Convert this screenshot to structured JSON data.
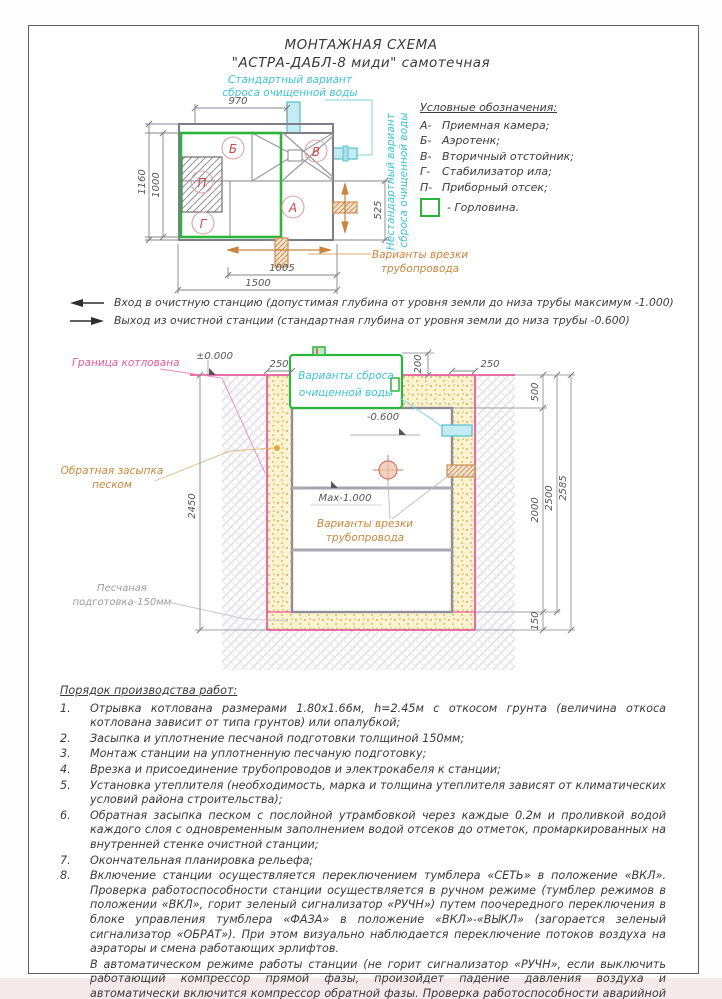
{
  "page": {
    "title_line1": "МОНТАЖНАЯ СХЕМА",
    "title_line2": "\"АСТРА-ДАБЛ-8 миди\"  самотечная"
  },
  "colors": {
    "green": "#2cb53c",
    "cyan": "#3fc3d2",
    "magenta": "#e75a9b",
    "orange": "#c8863c",
    "red_letters": "#cc4747",
    "sand": "#f9f1cf",
    "line_gray": "#8a8a92"
  },
  "plan": {
    "standard_discharge_1": "Стандартный вариант",
    "standard_discharge_2": "сброса очищенной воды",
    "nonstandard_discharge_1": "Нестандартный вариант",
    "nonstandard_discharge_2": "сброса очищенной воды",
    "pipe_insert_1": "Варианты врезки",
    "pipe_insert_2": "трубопровода",
    "chambers": {
      "A": "А",
      "B": "Б",
      "V": "В",
      "G": "Г",
      "P": "П"
    },
    "dims": {
      "d970": "970",
      "d1000": "1000",
      "d1160": "1160",
      "d525": "525",
      "d1005": "1005",
      "d1500": "1500"
    }
  },
  "legend": {
    "title": "Условные обозначения:",
    "items": [
      {
        "key": "А-",
        "label": "Приемная камера;"
      },
      {
        "key": "Б-",
        "label": "Аэротенк;"
      },
      {
        "key": "В-",
        "label": "Вторичный отстойник;"
      },
      {
        "key": "Г-",
        "label": "Стабилизатор ила;"
      },
      {
        "key": "П-",
        "label": "Приборный отсек;"
      }
    ],
    "neck_label": "- Горловина."
  },
  "notes": {
    "inlet": "Вход в очистную станцию (допустимая глубина от уровня земли до низа трубы максимум -1.000)",
    "outlet": "Выход из очистной станции (стандартная глубина от уровня земли до низа трубы -0.600)"
  },
  "section": {
    "labels": {
      "pit_boundary": "Граница котлована",
      "zero_level": "±0.000",
      "backfill_1": "Обратная засыпка",
      "backfill_2": "песком",
      "sand_prep_1": "Песчаная",
      "sand_prep_2": "подготовка-150мм",
      "minus_600": "-0.600",
      "max_1000": "Max-1.000",
      "discharge_1": "Варианты сброса",
      "discharge_2": "очищенной воды",
      "pipe_insert_1": "Варианты врезки",
      "pipe_insert_2": "трубопровода"
    },
    "dims": {
      "left250": "250",
      "right250": "250",
      "v200": "200",
      "v500": "500",
      "v2000": "2000",
      "v2450": "2450",
      "v2500": "2500",
      "v2585": "2585",
      "v150": "150"
    }
  },
  "procedure": {
    "title": "Порядок производства работ:",
    "items": [
      {
        "num": "1.",
        "text": "Отрывка котлована размерами 1.80х1.66м, h=2.45м с откосом грунта (величина откоса котлована зависит от типа грунтов) или опалубкой;"
      },
      {
        "num": "2.",
        "text": "Засыпка и уплотнение песчаной подготовки толщиной 150мм;"
      },
      {
        "num": "3.",
        "text": "Монтаж станции на уплотненную песчаную подготовку;"
      },
      {
        "num": "4.",
        "text": "Врезка и присоединение трубопроводов и электрокабеля к станции;"
      },
      {
        "num": "5.",
        "text": "Установка утеплителя (необходимость, марка и толщина утеплителя зависят от климатических условий района строительства);"
      },
      {
        "num": "6.",
        "text": "Обратная засыпка песком с послойной утрамбовкой через каждые 0.2м и проливкой водой каждого слоя с одновременным заполнением водой отсеков до отметок, промаркированных на внутренней стенке очистной станции;"
      },
      {
        "num": "7.",
        "text": "Окончательная планировка рельефа;"
      },
      {
        "num": "8.",
        "text": "Включение станции осуществляется переключением тумблера «СЕТЬ» в положение «ВКЛ». Проверка работоспособности станции осуществляется в ручном режиме (тумблер режимов в положении «ВКЛ», горит зеленый сигнализатор «РУЧН») путем поочередного переключения в блоке управления тумблера «ФАЗА»  в положение «ВКЛ»-«ВЫКЛ» (загорается зеленый сигнализатор «ОБРАТ»).   При этом визуально наблюдается переключение потоков воздуха на аэраторы и смена работающих эрлифтов."
      }
    ],
    "item8_extra": "В автоматическом режиме работы станции (не горит сигнализатор «РУЧН», если выключить работающий компрессор прямой фазы, произойдет падение давления воздуха и автоматически включится компрессор обратной фазы. Проверка работоспособности аварийной сигнализации осуществляется путем выключения двух компрессоров из розеток. В условиях  отсутствия давления воздуха на турбораспределителе загорается лампочка аварийной ситуации."
  }
}
